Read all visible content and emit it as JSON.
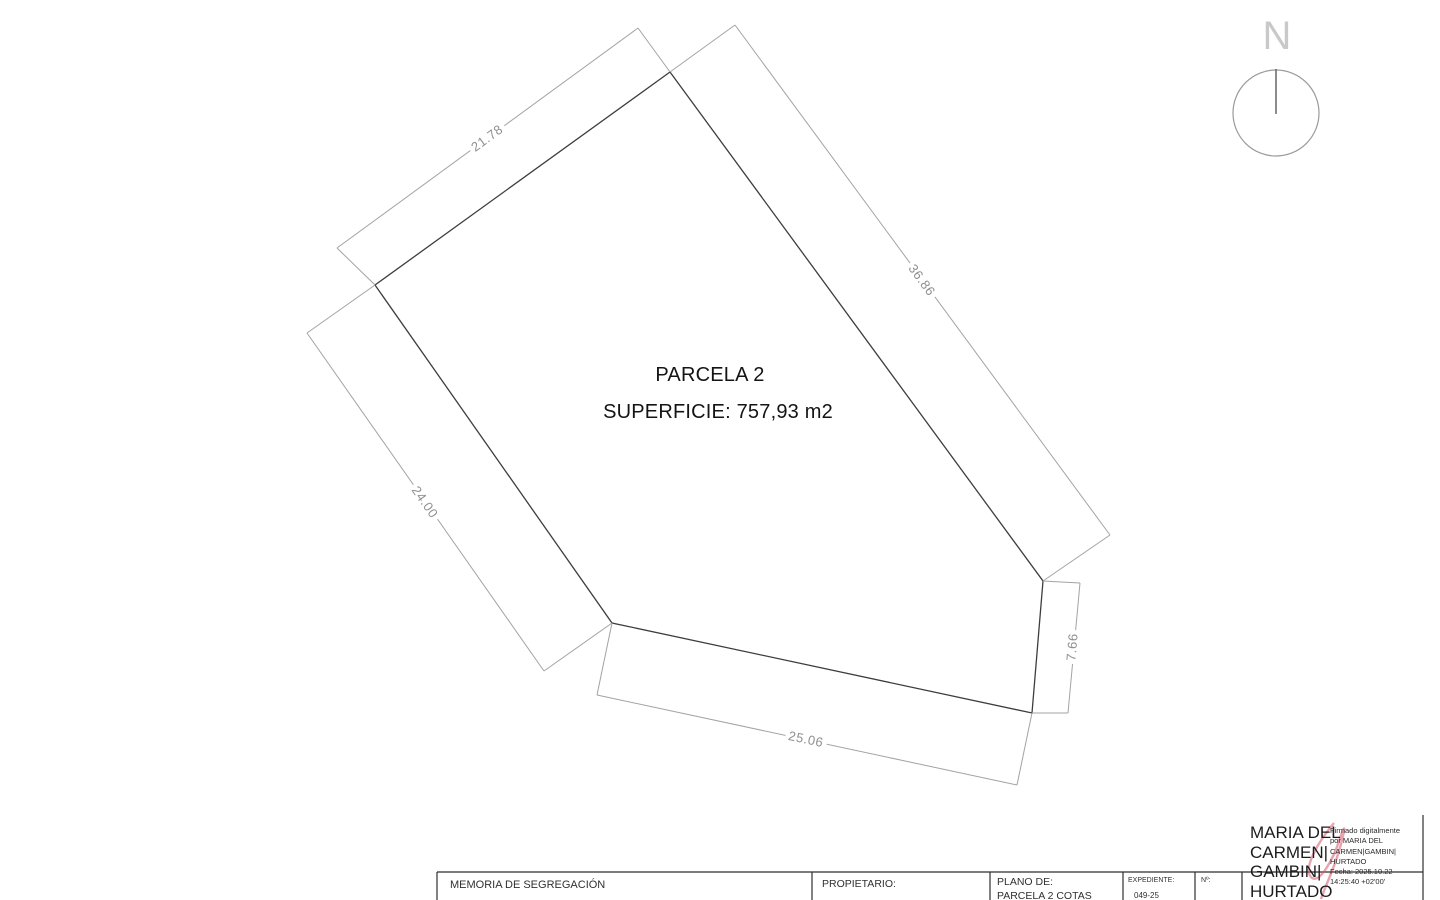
{
  "north": {
    "label": "N"
  },
  "parcel": {
    "title": "PARCELA 2",
    "surface": "SUPERFICIE: 757,93 m2",
    "dims": {
      "edge_upper_left": "21.78",
      "edge_right": "36.86",
      "edge_left": "24.00",
      "edge_bottom": "25.06",
      "edge_lower_right": "7.66"
    }
  },
  "title_block": {
    "memoria": "MEMORIA DE SEGREGACIÓN",
    "propietario_label": "PROPIETARIO:",
    "plano_label": "PLANO DE:",
    "plano_value": "PARCELA 2 COTAS",
    "expediente_label": "EXPEDIENTE:",
    "expediente_value": "049-25",
    "numero_label": "Nº:"
  },
  "signature": {
    "name_lines": [
      "MARIA DEL",
      "CARMEN|",
      "GAMBIN|",
      "HURTADO"
    ],
    "details_lines": [
      "Firmado digitalmente",
      "por MARIA DEL",
      "CARMEN|GAMBIN|",
      "HURTADO",
      "Fecha: 2025.10.22",
      "14:25:40 +02'00'"
    ]
  },
  "colors": {
    "parcel_edge": "#3d3d3d",
    "dimension_line": "#a3a3a3",
    "dimension_text": "#8f8f8f",
    "signature_accent": "#d65a6c"
  }
}
